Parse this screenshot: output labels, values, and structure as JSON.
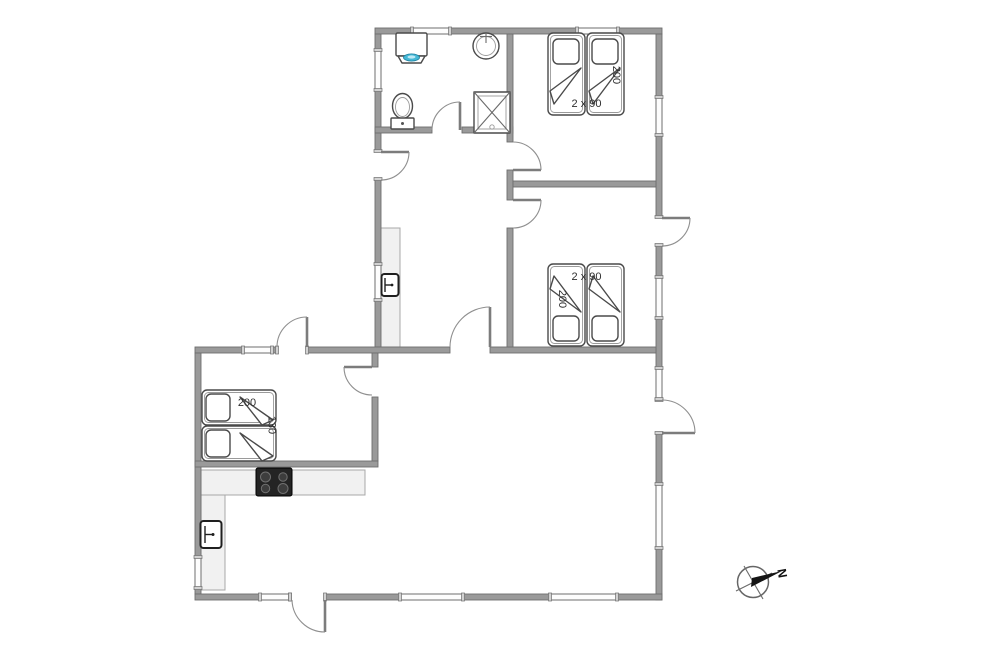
{
  "labels": {
    "bedrooms": {
      "top": {
        "size": "2 x 90",
        "length": "200"
      },
      "middle": {
        "size": "2 x 90",
        "length": "200"
      },
      "left": {
        "length": "200",
        "width": "130"
      }
    },
    "compass": {
      "north": "N"
    }
  },
  "fixtures": {
    "bathroom": [
      "washing-machine",
      "washbasin",
      "toilet",
      "shower-cabin"
    ],
    "hallway": [
      "wardrobe-cabinet",
      "water-heater"
    ],
    "kitchen": [
      "counter",
      "cooktop",
      "oven"
    ],
    "bedroom_top": [
      "twin-beds"
    ],
    "bedroom_middle": [
      "twin-beds"
    ],
    "bedroom_left": [
      "double-bed"
    ]
  },
  "colors": {
    "wall": "#9a9a9a",
    "wall-edge": "#6e6e6e",
    "counter": "#f1f1f1",
    "cooktop": "#242424",
    "water": "#45b8d6"
  }
}
